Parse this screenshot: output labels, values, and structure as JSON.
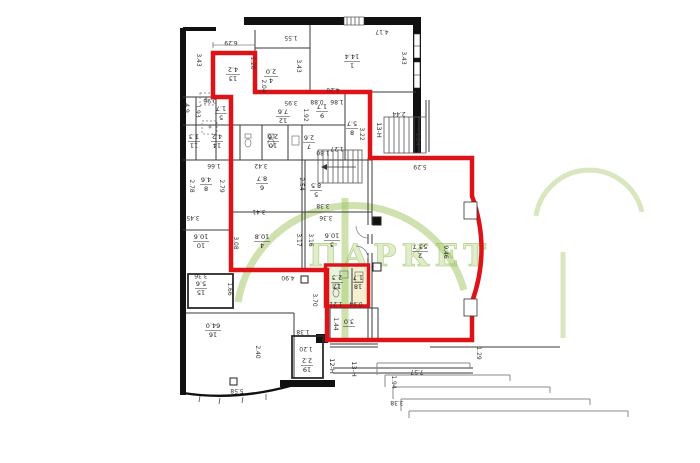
{
  "watermark": {
    "text": "ПАРКЕТ",
    "color": "#9ec45e"
  },
  "colors": {
    "red_outline": "#dd1318",
    "highlight_green": "rgba(150,200,80,0.22)",
    "highlight_yellow": "rgba(225,210,120,0.35)"
  },
  "rooms": {
    "r13": {
      "num": "13",
      "area": "4.2"
    },
    "r4s": {
      "num": "4",
      "area": "2.0"
    },
    "r1": {
      "num": "1",
      "area": "14.4"
    },
    "r5s": {
      "num": "5",
      "area": "1.7"
    },
    "r12": {
      "num": "12",
      "area": "7.6"
    },
    "r9": {
      "num": "9",
      "area": "1.7"
    },
    "r8b": {
      "num": "8",
      "area": "5.7"
    },
    "r11": {
      "num": "11",
      "area": "1.3"
    },
    "r14": {
      "num": "14",
      "area": "4.2"
    },
    "r10s": {
      "num": "10",
      "area": "2.6"
    },
    "r7": {
      "num": "7",
      "area": "2.6"
    },
    "r8": {
      "num": "8",
      "area": "4.6"
    },
    "r6": {
      "num": "6",
      "area": "8.7"
    },
    "r5": {
      "num": "5",
      "area": "8.5"
    },
    "r10": {
      "num": "10",
      "area": "10.6"
    },
    "r4": {
      "num": "4",
      "area": "10.8"
    },
    "r3": {
      "num": "3",
      "area": "10.6"
    },
    "r2": {
      "num": "2",
      "area": "53.7"
    },
    "r15": {
      "num": "15",
      "area": "5.6"
    },
    "r16": {
      "num": "16",
      "area": "64.0"
    },
    "r17": {
      "num": "17",
      "area": "2.3"
    },
    "r18": {
      "num": "18",
      "area": "1.7"
    },
    "r19": {
      "num": "19",
      "area": "2.2"
    },
    "rt": {
      "num": "",
      "area": "3.0"
    }
  },
  "corridors": [
    "13-Н",
    "12-Н",
    "13-Н"
  ],
  "dims": [
    "6.29",
    "1.20",
    "1.55",
    "4.17",
    "3.43",
    "3.43",
    "3.43",
    "2.04",
    "4.20",
    "0.96",
    "1.93",
    "4.9",
    "3.95",
    "1.92",
    "0.88",
    "1.86",
    "3.22",
    "1.80",
    "1.27",
    "2.44",
    "1.24",
    "1.66",
    "3.42",
    "2.78",
    "2.79",
    "3.45",
    "3.08",
    "3.41",
    "2.54",
    "3.17",
    "3.16",
    "3.38",
    "3.36",
    "5.29",
    "9.46",
    "3.36",
    "1.66",
    "4.90",
    "3.70",
    "1.21",
    "0.94",
    "1.44",
    "1.38",
    "1.20",
    "2.40",
    "5.58",
    "1.29",
    "7.57",
    "1.94",
    "3.38"
  ]
}
